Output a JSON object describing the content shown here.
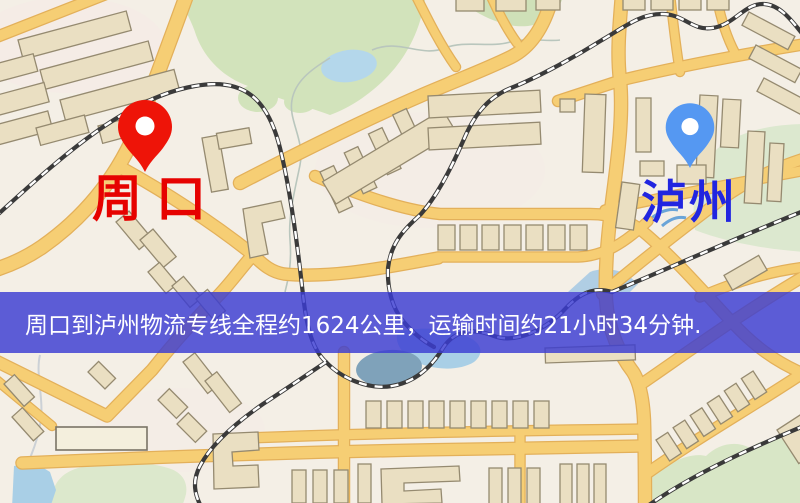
{
  "map": {
    "markers": {
      "origin": {
        "name": "周口",
        "icon": "red-map-pin-icon",
        "pin_color": "#ee1408",
        "label_color": "#e60200"
      },
      "destination": {
        "name": "泸州",
        "icon": "blue-map-pin-icon",
        "pin_color": "#5598f2",
        "label_color": "#2125e0"
      }
    },
    "banner": {
      "text": "周口到泸州物流专线全程约1624公里，运输时间约21小时34分钟.",
      "background": "rgba(58,60,210,0.82)",
      "text_color": "#ffffff"
    },
    "palette": {
      "background": "#f4efe6",
      "road": "#f6ce74",
      "road_casing": "#e3b05a",
      "railway": "#3a3a3a",
      "building": "#eadfc2",
      "building_outline": "#958a70",
      "park": "#d4e4c0",
      "water": "#a9cfe6",
      "pond": "#7fa2ba"
    }
  }
}
